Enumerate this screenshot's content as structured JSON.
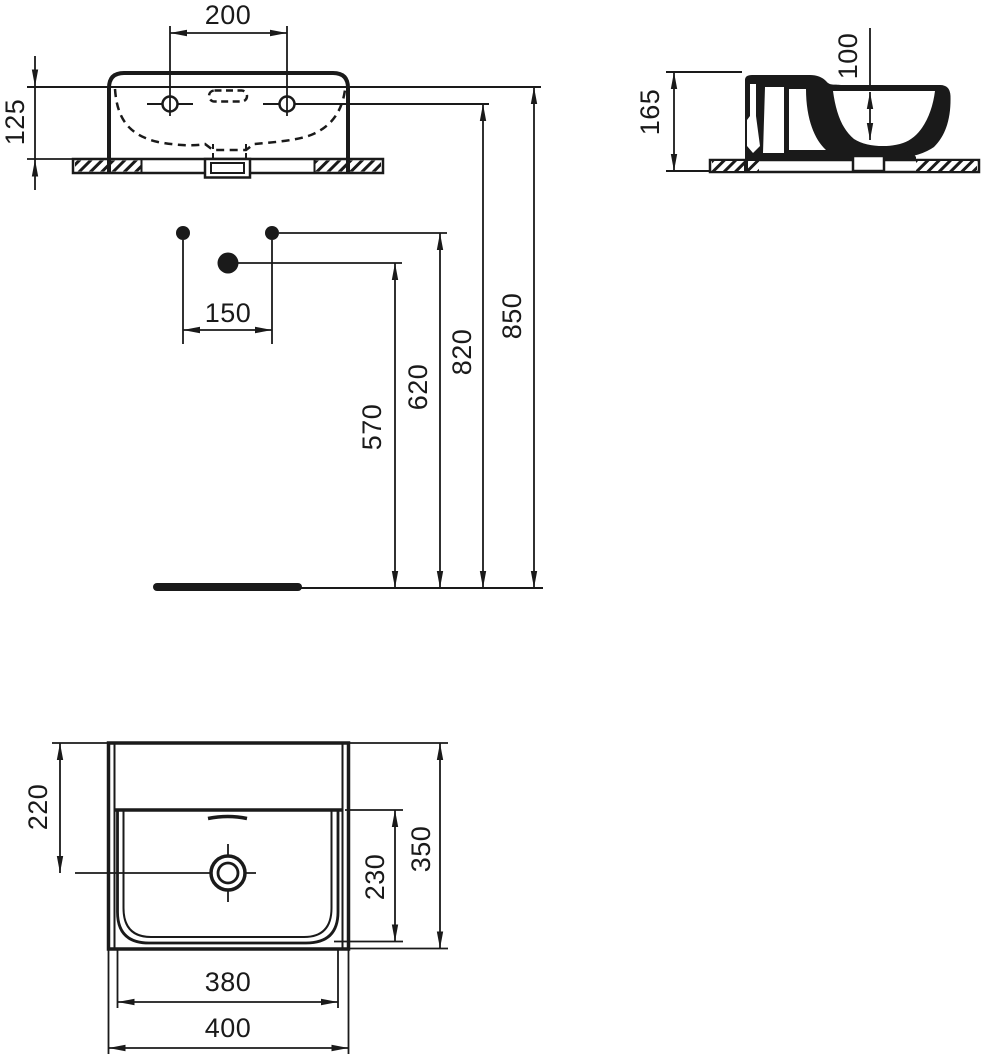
{
  "drawing": {
    "kind": "washbasin-technical-drawing",
    "colors": {
      "line": "#1a1a1a",
      "background": "#ffffff"
    },
    "views": {
      "front_view": "front elevation",
      "side_view": "side section",
      "installation_view": "installation heights",
      "plan_view": "plan (top) view"
    },
    "dimensions_mm": {
      "front": {
        "tap_hole_spacing": "200",
        "front_height": "125"
      },
      "side": {
        "overall_height": "165",
        "bowl_inner_depth": "100"
      },
      "installation": {
        "supply_spacing": "150",
        "waste_outlet_height": "570",
        "supply_height": "620",
        "fixing_hole_height": "820",
        "rim_height": "850"
      },
      "plan": {
        "waste_from_back": "220",
        "waste_from_front_inner": "230",
        "overall_depth": "350",
        "bowl_width": "380",
        "overall_width": "400"
      }
    }
  }
}
